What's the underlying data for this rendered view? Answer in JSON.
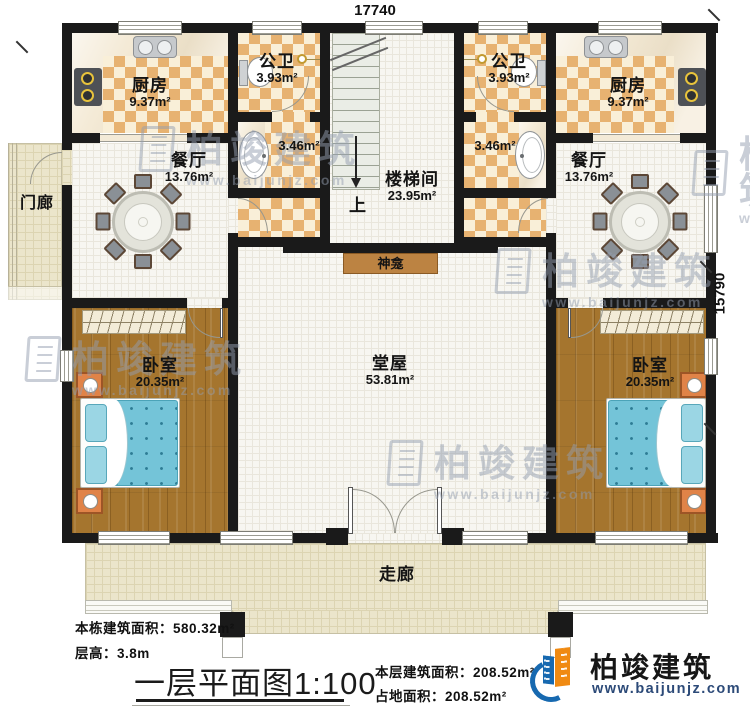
{
  "dimensions": {
    "top": "17740",
    "right": "15790"
  },
  "rooms": {
    "kitchen_left": {
      "name": "厨房",
      "area": "9.37m²"
    },
    "kitchen_right": {
      "name": "厨房",
      "area": "9.37m²"
    },
    "pubbath_left": {
      "name": "公卫",
      "area": "3.93m²"
    },
    "pubbath_right": {
      "name": "公卫",
      "area": "3.93m²"
    },
    "wash_left": {
      "area": "3.46m²"
    },
    "wash_right": {
      "area": "3.46m²"
    },
    "dining_left": {
      "name": "餐厅",
      "area": "13.76m²"
    },
    "dining_right": {
      "name": "餐厅",
      "area": "13.76m²"
    },
    "stairwell": {
      "name": "楼梯间",
      "area": "23.95m²",
      "up": "上"
    },
    "shrine": {
      "name": "神龛"
    },
    "hall": {
      "name": "堂屋",
      "area": "53.81m²"
    },
    "bedroom_left": {
      "name": "卧室",
      "area": "20.35m²"
    },
    "bedroom_right": {
      "name": "卧室",
      "area": "20.35m²"
    },
    "porch": {
      "name": "门廊"
    },
    "corridor": {
      "name": "走廊"
    }
  },
  "footer": {
    "building_area": "本栋建筑面积：580.32m²",
    "floor_height": "层高：3.8m",
    "plan_title": "一层平面图",
    "plan_scale": "1:100",
    "floor_area": "本层建筑面积：208.52m²",
    "site_area": "占地面积：208.52m²"
  },
  "brand": {
    "name": "柏竣建筑",
    "url": "www.baijunjz.com"
  },
  "watermark": {
    "name": "柏竣建筑",
    "url": "www.baijunjz.com"
  },
  "colors": {
    "wall": "#1a1a1a",
    "checker": "#e7b271",
    "wood": "#a5752e",
    "bed_blue": "#74c4d8",
    "floor_beige": "#ebe5cb",
    "brand_blue": "#1769b0",
    "brand_orange": "#f08a12"
  }
}
